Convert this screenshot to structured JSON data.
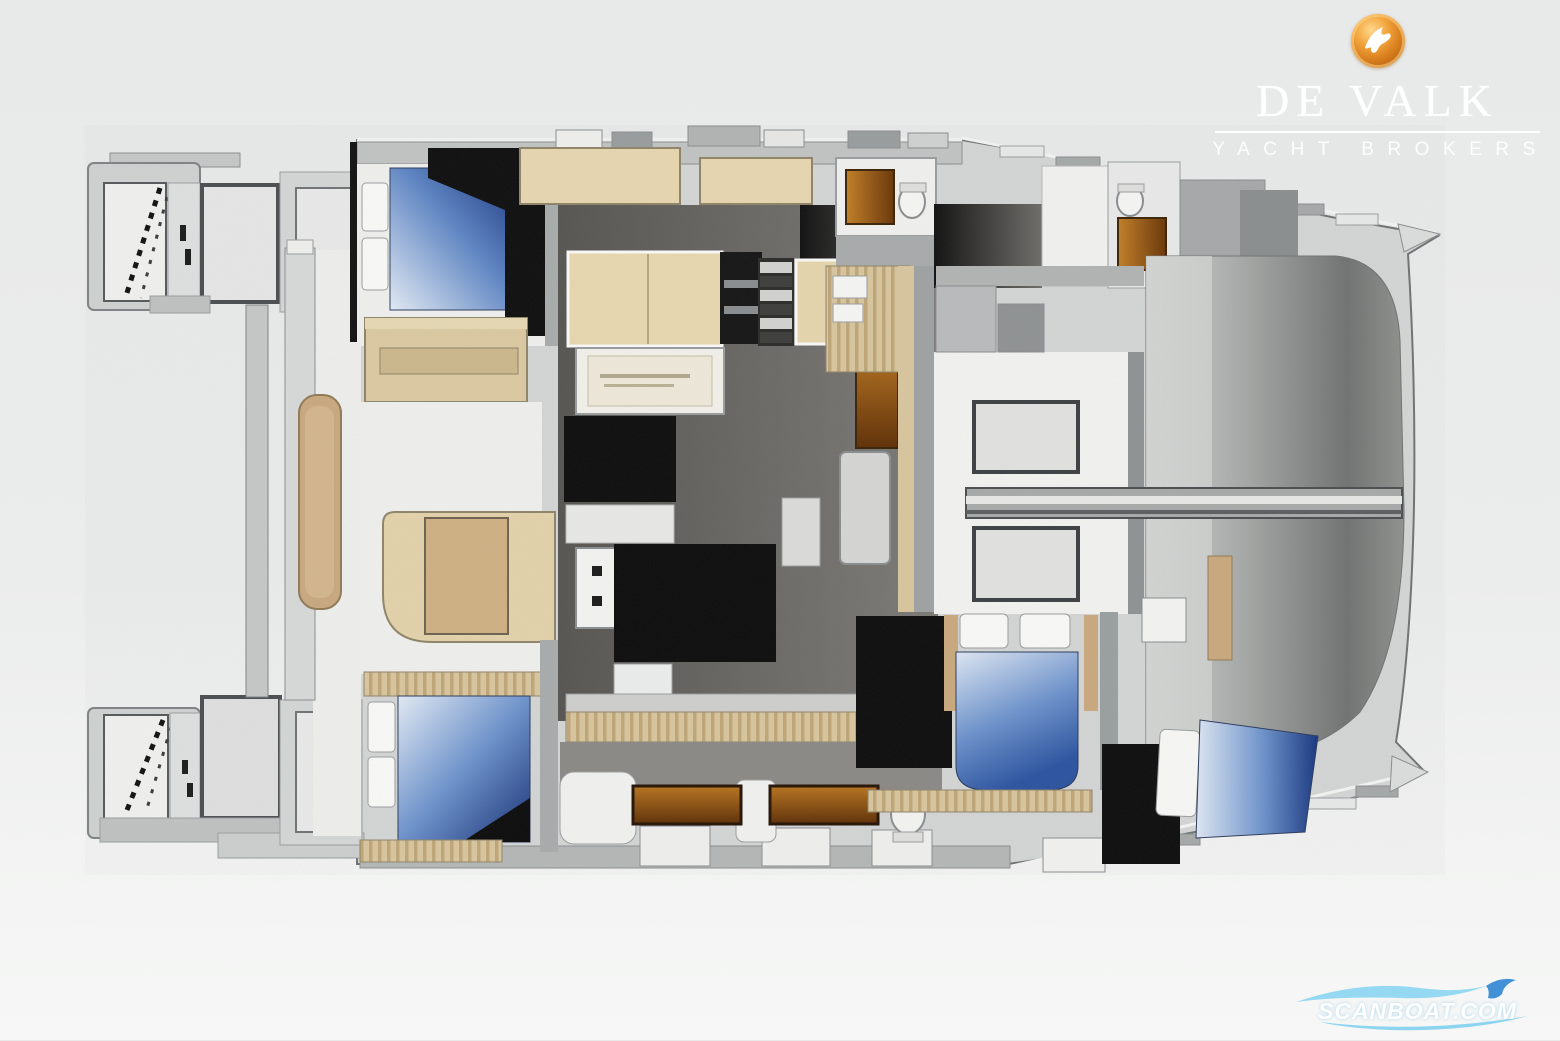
{
  "page": {
    "background_color": "#ebecec",
    "width": 1560,
    "height": 1040
  },
  "brand": {
    "name": "DE VALK",
    "tagline": "YACHT BROKERS",
    "logo_icon": "falcon-sphere-icon",
    "colors": {
      "sphere_orange": "#d97f1e",
      "sphere_highlight": "#ffd98e",
      "text": "#ffffff"
    }
  },
  "watermark": {
    "text": "SCANBOAT.COM",
    "icon": "wave-swoosh-icon",
    "colors": {
      "wave_light": "#8ad5f2",
      "wave_mid": "#4fb2e8",
      "wave_accent": "#2f86d4",
      "text": "#ffffff"
    }
  },
  "floor_plan": {
    "type": "diagram",
    "subject": "catamaran yacht deck and accommodation plan",
    "orientation": "bow-right, stern-left",
    "double_berths_visible": 4,
    "regions": [
      {
        "id": "swim-platform-port",
        "label": "Port swim platform with transom steps"
      },
      {
        "id": "swim-platform-starboard",
        "label": "Starboard swim platform with transom steps"
      },
      {
        "id": "aft-cockpit",
        "label": "Aft cockpit with table pod"
      },
      {
        "id": "port-forward-cabin",
        "label": "Port forward double cabin"
      },
      {
        "id": "port-aft-cabin",
        "label": "Port aft double cabin"
      },
      {
        "id": "port-head",
        "label": "Port head with shower"
      },
      {
        "id": "saloon",
        "label": "Saloon with sofa, sideboard and seat"
      },
      {
        "id": "galley",
        "label": "Galley with sink and counters"
      },
      {
        "id": "companionway-stairs",
        "label": "Companionway stairs"
      },
      {
        "id": "starboard-head",
        "label": "Starboard head with shower"
      },
      {
        "id": "starboard-aft-cabin",
        "label": "Starboard aft double cabin"
      },
      {
        "id": "starboard-forward-cabin",
        "label": "Starboard forward double cabin"
      },
      {
        "id": "forward-deck-lounge",
        "label": "Forward deck with sun-pad hatches"
      },
      {
        "id": "foredeck",
        "label": "Foredeck / trampoline area"
      },
      {
        "id": "bow-walkway",
        "label": "Centreline walkway to bow"
      }
    ],
    "palette": {
      "deck": "#d3d5d5",
      "floor_white": "#f0f0ee",
      "saloon_floor": "#6e6c68",
      "furniture_tan": "#e6d6ae",
      "wood_brown": "#8a4a10",
      "bed_blue_dark": "#16357f",
      "bed_blue_light": "#e2eaf6",
      "wardrobe_black": "#0c0c0c",
      "foredeck_gray": "#747672"
    }
  }
}
